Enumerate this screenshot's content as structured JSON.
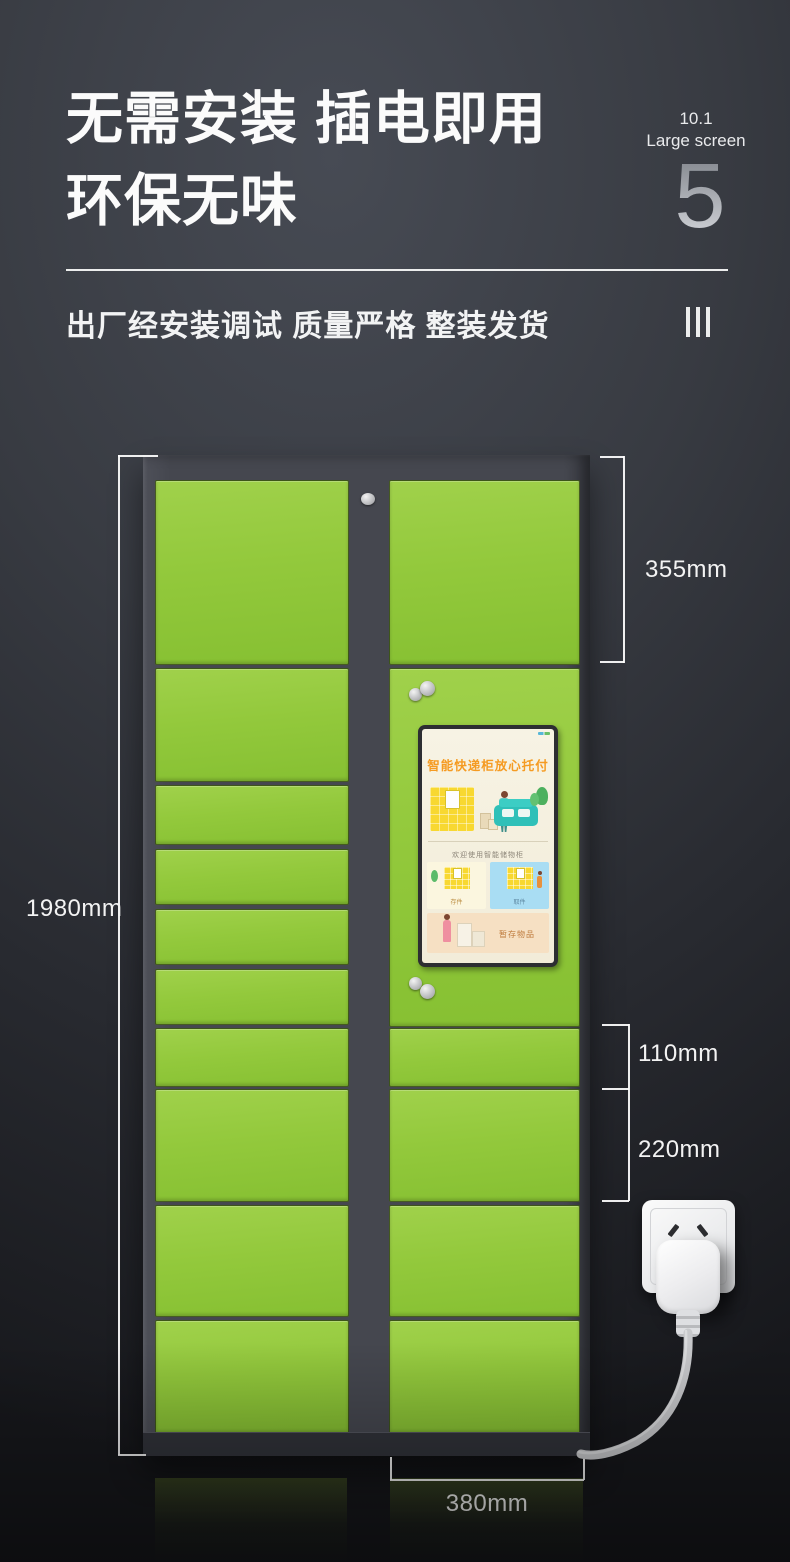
{
  "header": {
    "title_line1": "无需安装 插电即用",
    "title_line2": "环保无味",
    "screen_spec_size": "10.1",
    "screen_spec_label": "Large screen",
    "page_number": "5",
    "subtitle": "出厂经安装调试 质量严格 整装发货"
  },
  "dimensions": {
    "cabinet_height": "1980mm",
    "top_door_height": "355mm",
    "small_door_height": "110mm",
    "medium_door_height": "220mm",
    "cabinet_depth": "380mm"
  },
  "locker_screen": {
    "title": "智能快递柜放心托付",
    "welcome": "欢迎使用智能储物柜",
    "card_left_label": "存件",
    "card_right_label": "取件",
    "bottom_card_label": "暂存物品"
  },
  "colors": {
    "door_green": "#93c93c",
    "cabinet_gray": "#45474f",
    "background_dark": "#2b2d33",
    "accent_orange": "#f59b22",
    "kiosk_bg_cream": "#f4efdf",
    "sofa_teal": "#2fc0b8",
    "mini_locker_yellow": "#f8d831",
    "card_blue": "#a9ddf3",
    "card_tan": "#f6e0c3",
    "dimension_text": "#f3f3f3"
  }
}
